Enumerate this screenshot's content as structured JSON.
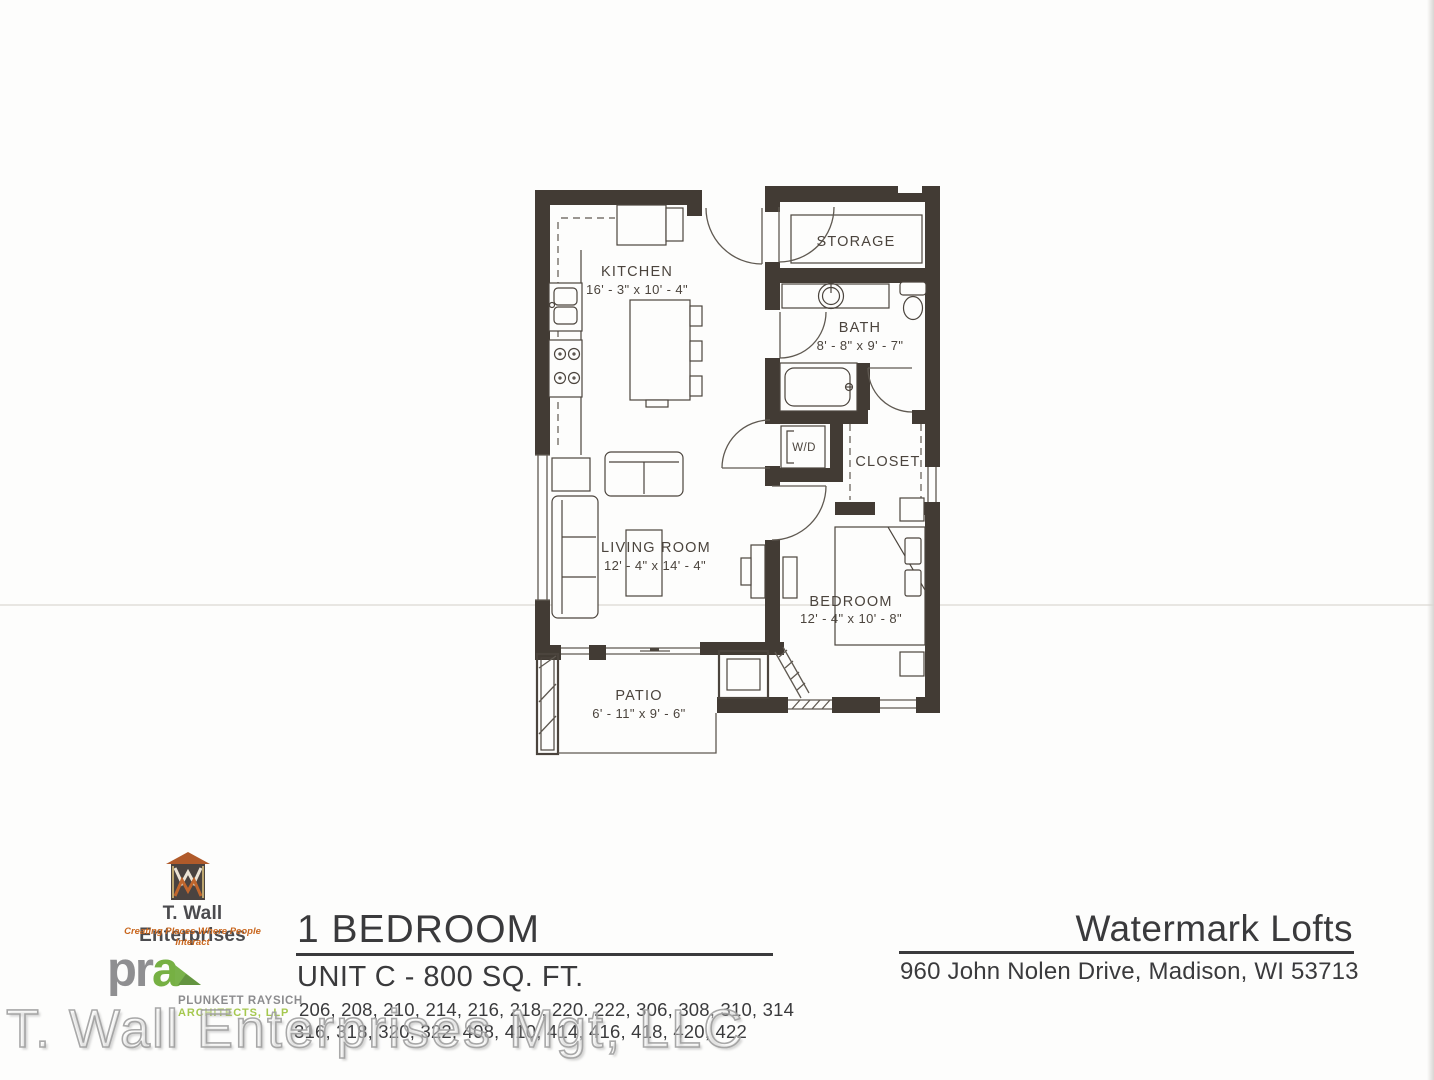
{
  "colors": {
    "wall": "#423b34",
    "ink": "#4b443d",
    "furn": "#5f5951",
    "text-dark": "#3a3a3c",
    "orange": "#c9671f",
    "green": "#76b043",
    "green-light": "#a5c84e",
    "gray-logo": "#8f8f91"
  },
  "plan": {
    "rooms": {
      "kitchen": {
        "name": "KITCHEN",
        "dims": "16' - 3\" x 10' - 4\""
      },
      "storage": {
        "name": "STORAGE"
      },
      "bath": {
        "name": "BATH",
        "dims": "8' - 8\" x 9' - 7\""
      },
      "wd": {
        "name": "W/D"
      },
      "closet": {
        "name": "CLOSET"
      },
      "living_room": {
        "name": "LIVING ROOM",
        "dims": "12' - 4\" x 14' - 4\""
      },
      "bedroom": {
        "name": "BEDROOM",
        "dims": "12' - 4\" x 10' - 8\""
      },
      "patio": {
        "name": "PATIO",
        "dims": "6' - 11\" x 9' - 6\""
      }
    }
  },
  "branding": {
    "twall": {
      "name": "T. Wall Enterprises",
      "tagline": "Creating Places Where People Interact"
    },
    "pra": {
      "pr": "pr",
      "a": "a",
      "line1": "PLUNKETT RAYSICH",
      "line2": "ARCHITECTS, LLP"
    }
  },
  "unit_info": {
    "plan_type": "1 BEDROOM",
    "unit_title": "UNIT C - 800 SQ. FT.",
    "units_line1": "206, 208, 210, 214, 216, 218, 220. 222, 306, 308, 310, 314",
    "units_line2": "316, 318, 320, 322, 408, 410, 414, 416, 418, 420, 422"
  },
  "property": {
    "name": "Watermark Lofts",
    "address": "960 John Nolen Drive, Madison, WI 53713"
  },
  "watermark_text": "T. Wall Enterprises Mgt, LLC"
}
